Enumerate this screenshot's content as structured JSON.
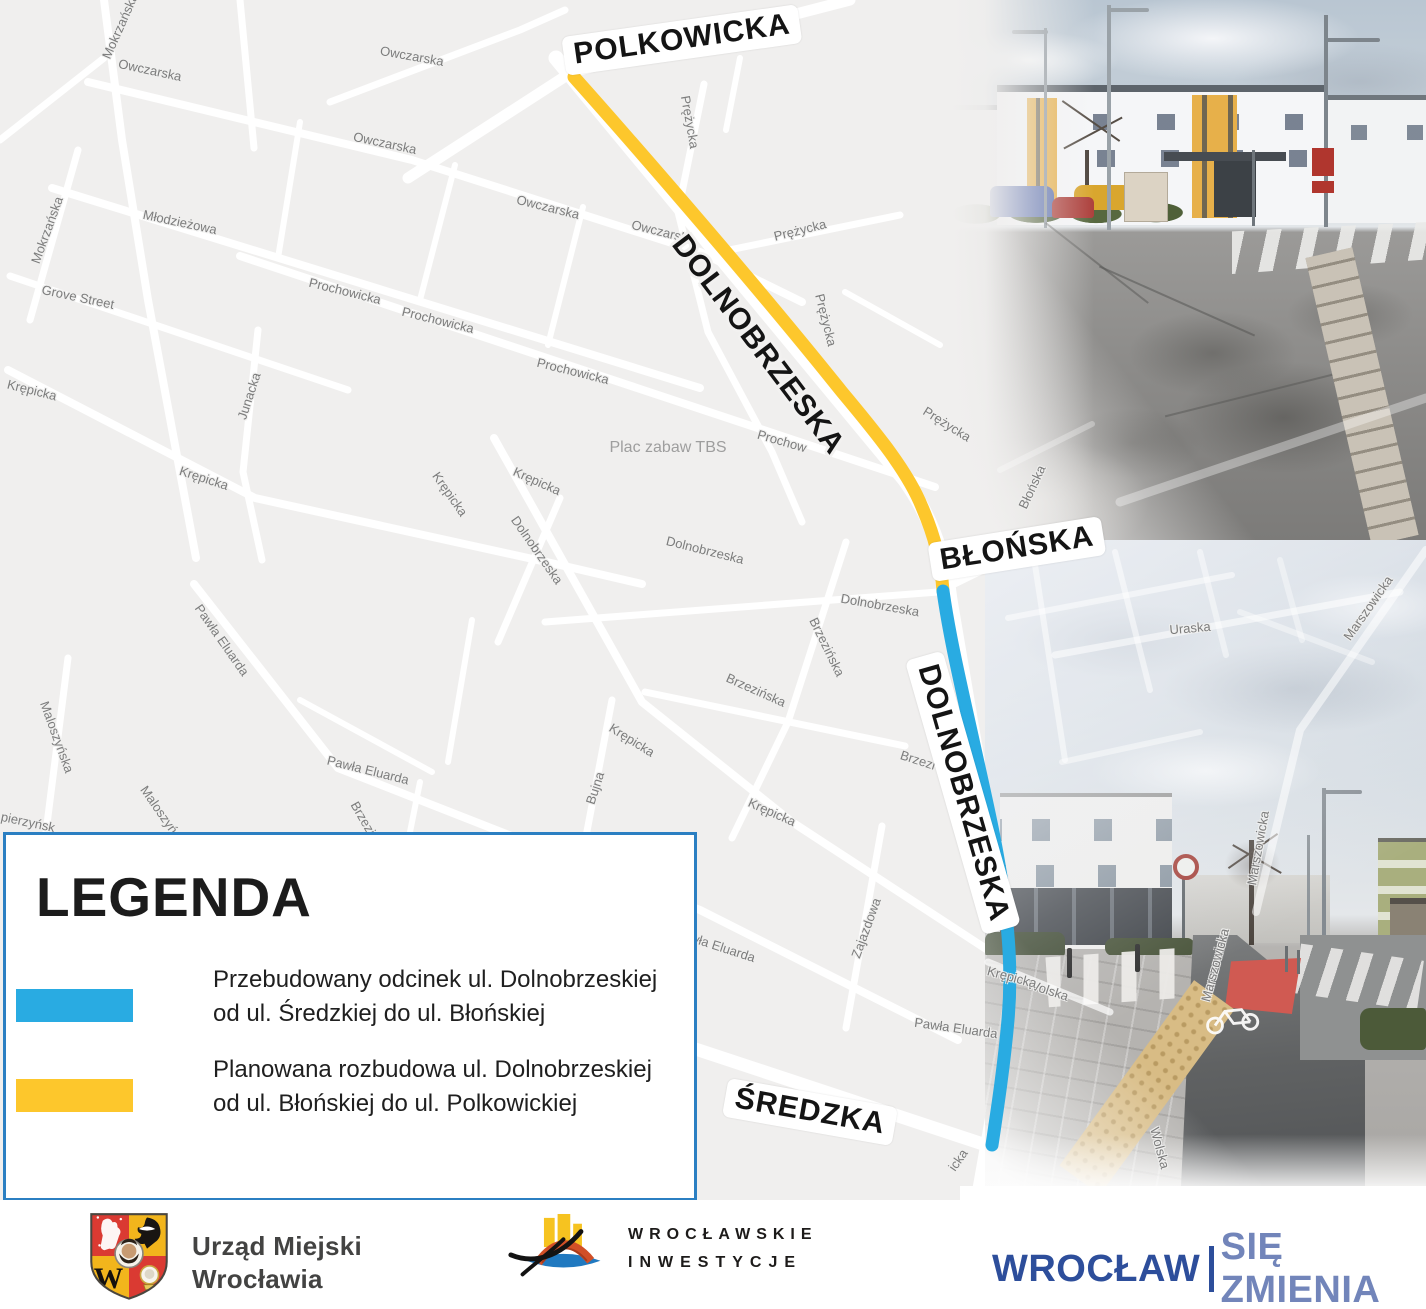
{
  "map": {
    "background_color": "#f0efee",
    "street_color": "#ffffff",
    "major_labels": [
      {
        "t": "POLKOWICKA",
        "x": 682,
        "y": 40,
        "r": -8,
        "pill": true
      },
      {
        "t": "DOLNOBRZESKA",
        "x": 758,
        "y": 345,
        "r": 53,
        "pill": false
      },
      {
        "t": "BŁOŃSKA",
        "x": 1017,
        "y": 549,
        "r": -9,
        "pill": true
      },
      {
        "t": "DOLNOBRZESKA",
        "x": 963,
        "y": 793,
        "r": 74,
        "pill": true
      },
      {
        "t": "ŚREDZKA",
        "x": 810,
        "y": 1112,
        "r": 10,
        "pill": true
      }
    ],
    "street_labels": [
      {
        "t": "Mokrzańska",
        "x": 120,
        "y": 26,
        "r": -66
      },
      {
        "t": "Owczarska",
        "x": 150,
        "y": 70,
        "r": 12
      },
      {
        "t": "Owczarska",
        "x": 412,
        "y": 56,
        "r": 10
      },
      {
        "t": "Owczarska",
        "x": 385,
        "y": 143,
        "r": 12
      },
      {
        "t": "Owczarska",
        "x": 548,
        "y": 207,
        "r": 14
      },
      {
        "t": "Owczarska",
        "x": 663,
        "y": 232,
        "r": 14
      },
      {
        "t": "Prężycka",
        "x": 690,
        "y": 122,
        "r": 80
      },
      {
        "t": "Prężycka",
        "x": 800,
        "y": 230,
        "r": -14
      },
      {
        "t": "Prężycka",
        "x": 826,
        "y": 320,
        "r": 76
      },
      {
        "t": "Prężycka",
        "x": 947,
        "y": 424,
        "r": 32
      },
      {
        "t": "Młodzieżowa",
        "x": 180,
        "y": 222,
        "r": 12
      },
      {
        "t": "Grove Street",
        "x": 78,
        "y": 297,
        "r": 12
      },
      {
        "t": "Mokrzańska",
        "x": 47,
        "y": 230,
        "r": -70
      },
      {
        "t": "Prochowicka",
        "x": 345,
        "y": 291,
        "r": 14
      },
      {
        "t": "Prochowicka",
        "x": 438,
        "y": 320,
        "r": 14
      },
      {
        "t": "Prochowicka",
        "x": 573,
        "y": 371,
        "r": 14
      },
      {
        "t": "Prochow",
        "x": 782,
        "y": 441,
        "r": 16
      },
      {
        "t": "Krępicka",
        "x": 32,
        "y": 390,
        "r": 14
      },
      {
        "t": "Krępicka",
        "x": 204,
        "y": 478,
        "r": 18
      },
      {
        "t": "Junacka",
        "x": 249,
        "y": 396,
        "r": -72
      },
      {
        "t": "Krępicka",
        "x": 450,
        "y": 494,
        "r": 55
      },
      {
        "t": "Krępicka",
        "x": 537,
        "y": 481,
        "r": 24
      },
      {
        "t": "Dolnobrzeska",
        "x": 537,
        "y": 550,
        "r": 55
      },
      {
        "t": "Dolnobrzeska",
        "x": 705,
        "y": 550,
        "r": 14
      },
      {
        "t": "Dolnobrzeska",
        "x": 880,
        "y": 605,
        "r": 10
      },
      {
        "t": "Brzezińska",
        "x": 756,
        "y": 690,
        "r": 24
      },
      {
        "t": "Brzezińska",
        "x": 827,
        "y": 647,
        "r": 64
      },
      {
        "t": "Brzezi",
        "x": 918,
        "y": 760,
        "r": 18
      },
      {
        "t": "Brzezińska",
        "x": 370,
        "y": 830,
        "r": 60
      },
      {
        "t": "Brzezińska",
        "x": 150,
        "y": 928,
        "r": 18
      },
      {
        "t": "Bujna",
        "x": 595,
        "y": 788,
        "r": -72
      },
      {
        "t": "Zajazdowa",
        "x": 866,
        "y": 928,
        "r": -70
      },
      {
        "t": "Pawła Eluarda",
        "x": 222,
        "y": 640,
        "r": 55
      },
      {
        "t": "Pawła Eluarda",
        "x": 368,
        "y": 770,
        "r": 14
      },
      {
        "t": "Pawła Eluarda",
        "x": 715,
        "y": 945,
        "r": 18
      },
      {
        "t": "Pawła Eluarda",
        "x": 956,
        "y": 1028,
        "r": 8
      },
      {
        "t": "Wolska",
        "x": 1048,
        "y": 990,
        "r": 18
      },
      {
        "t": "Wolska",
        "x": 1160,
        "y": 1148,
        "r": 75
      },
      {
        "t": "icka",
        "x": 958,
        "y": 1160,
        "r": -55
      },
      {
        "t": "Uraska",
        "x": 1190,
        "y": 628,
        "r": -5
      },
      {
        "t": "Marszowicka",
        "x": 1368,
        "y": 608,
        "r": -55
      },
      {
        "t": "Marszowicka",
        "x": 1258,
        "y": 848,
        "r": -80
      },
      {
        "t": "Marszowicka",
        "x": 1215,
        "y": 965,
        "r": -75
      },
      {
        "t": "Błońska",
        "x": 1032,
        "y": 487,
        "r": -65
      },
      {
        "t": "Maloszyńska",
        "x": 57,
        "y": 737,
        "r": 70
      },
      {
        "t": "Maloszyńska",
        "x": 165,
        "y": 818,
        "r": 55
      },
      {
        "t": "Krępicka",
        "x": 632,
        "y": 740,
        "r": 32
      },
      {
        "t": "Krępicka",
        "x": 772,
        "y": 812,
        "r": 24
      },
      {
        "t": "Krępicka",
        "x": 1012,
        "y": 977,
        "r": 15
      },
      {
        "t": "pierzyńsk",
        "x": 28,
        "y": 822,
        "r": 12
      }
    ],
    "poi_labels": [
      {
        "t": "Plac zabaw TBS",
        "x": 668,
        "y": 448,
        "r": 0
      }
    ],
    "routes": {
      "planned": {
        "color": "#fdc72c",
        "width": 13,
        "path": "M574,77 C648,160 762,292 842,392 C878,435 908,472 922,507 C935,537 941,562 943,591"
      },
      "reconstructed": {
        "color": "#29abe2",
        "width": 13,
        "path": "M943,591 C950,640 962,690 973,740 C984,790 996,840 1003,890 C1009,935 1012,975 1008,1020 C1004,1065 998,1105 992,1145"
      }
    },
    "streets": [
      {
        "d": "M556,58 L905,480 Q942,532 950,600 L1006,930 Q1013,1000 1001,1070 L986,1155 L978,1200",
        "w": 15
      },
      {
        "d": "M408,178 L572,72 L850,0",
        "w": 11
      },
      {
        "d": "M88,82 L412,160 L700,252 L802,302",
        "w": 8
      },
      {
        "d": "M330,102 L520,30 L565,10",
        "w": 7
      },
      {
        "d": "M240,0 L254,148",
        "w": 7
      },
      {
        "d": "M104,0 L122,140 L148,300 L196,558",
        "w": 8
      },
      {
        "d": "M78,150 L30,320",
        "w": 7
      },
      {
        "d": "M52,188 L700,388",
        "w": 8
      },
      {
        "d": "M10,276 L348,390",
        "w": 7
      },
      {
        "d": "M240,256 L935,487",
        "w": 8
      },
      {
        "d": "M704,84 L678,212 L708,332 L772,452 L802,522",
        "w": 7
      },
      {
        "d": "M690,258 L900,215",
        "w": 7
      },
      {
        "d": "M8,370 L255,498 L560,565 L642,584",
        "w": 8
      },
      {
        "d": "M258,330 L243,472 L262,560",
        "w": 7
      },
      {
        "d": "M455,165 L420,300",
        "w": 6
      },
      {
        "d": "M583,207 L548,345",
        "w": 6
      },
      {
        "d": "M300,122 L278,258",
        "w": 6
      },
      {
        "d": "M494,438 L642,702 L792,822 L1000,958",
        "w": 8
      },
      {
        "d": "M545,622 L938,592",
        "w": 7
      },
      {
        "d": "M560,498 L498,642",
        "w": 7
      },
      {
        "d": "M846,542 L788,722 L732,838",
        "w": 7
      },
      {
        "d": "M645,692 L905,746",
        "w": 7
      },
      {
        "d": "M612,700 L580,868",
        "w": 7
      },
      {
        "d": "M882,826 L846,1028",
        "w": 7
      },
      {
        "d": "M194,584 L338,768 L700,910 L958,1040",
        "w": 8
      },
      {
        "d": "M68,658 L46,832",
        "w": 7
      },
      {
        "d": "M638,1030 L995,1148 L1120,1196",
        "w": 13
      },
      {
        "d": "M420,782 L396,902",
        "w": 6
      },
      {
        "d": "M300,700 L432,772",
        "w": 6
      },
      {
        "d": "M472,620 L448,762",
        "w": 6
      },
      {
        "d": "M940,590 L1120,502",
        "w": 9
      },
      {
        "d": "M0,140 L104,58",
        "w": 7
      },
      {
        "d": "M845,292 L940,345",
        "w": 6
      },
      {
        "d": "M740,58 L726,130",
        "w": 6
      }
    ],
    "overlay_streets": [
      {
        "d": "M1120,502 L1426,398",
        "w": 9,
        "o": 0.35
      },
      {
        "d": "M1000,470 L1092,424",
        "w": 6,
        "o": 0.3
      },
      {
        "d": "M1055,655 L1400,592",
        "w": 7,
        "o": 0.55
      },
      {
        "d": "M1035,565 L1065,760",
        "w": 6,
        "o": 0.5
      },
      {
        "d": "M1115,552 L1150,690",
        "w": 6,
        "o": 0.5
      },
      {
        "d": "M1008,618 L1232,575",
        "w": 6,
        "o": 0.5
      },
      {
        "d": "M1200,552 L1226,655",
        "w": 6,
        "o": 0.45
      },
      {
        "d": "M1426,550 L1300,730 L1256,912",
        "w": 8,
        "o": 0.55
      },
      {
        "d": "M988,962 L1110,1012",
        "w": 7,
        "o": 0.7
      },
      {
        "d": "M1240,612 L1372,662",
        "w": 6,
        "o": 0.4
      },
      {
        "d": "M1062,762 L1200,732",
        "w": 6,
        "o": 0.45
      },
      {
        "d": "M1280,560 L1302,640",
        "w": 6,
        "o": 0.4
      }
    ]
  },
  "legend": {
    "title": "LEGENDA",
    "border_color": "#2b7fc2",
    "items": [
      {
        "swatch_color": "#29abe2",
        "line1": "Przebudowany odcinek ul. Dolnobrzeskiej",
        "line2": "od ul. Średzkiej do ul. Błońskiej"
      },
      {
        "swatch_color": "#fdc72c",
        "line1": "Planowana rozbudowa ul. Dolnobrzeskiej",
        "line2": "od ul. Błońskiej do ul. Polkowickiej"
      }
    ]
  },
  "footer": {
    "city_office_line1": "Urząd Miejski",
    "city_office_line2": "Wrocławia",
    "investments_line1": "WROCŁAWSKIE",
    "investments_line2": "INWESTYCJE",
    "slogan_left": "WROCŁAW",
    "slogan_right": "SIĘ ZMIENIA",
    "slogan_left_color": "#2d4e9b",
    "slogan_right_color": "#7285ba"
  }
}
